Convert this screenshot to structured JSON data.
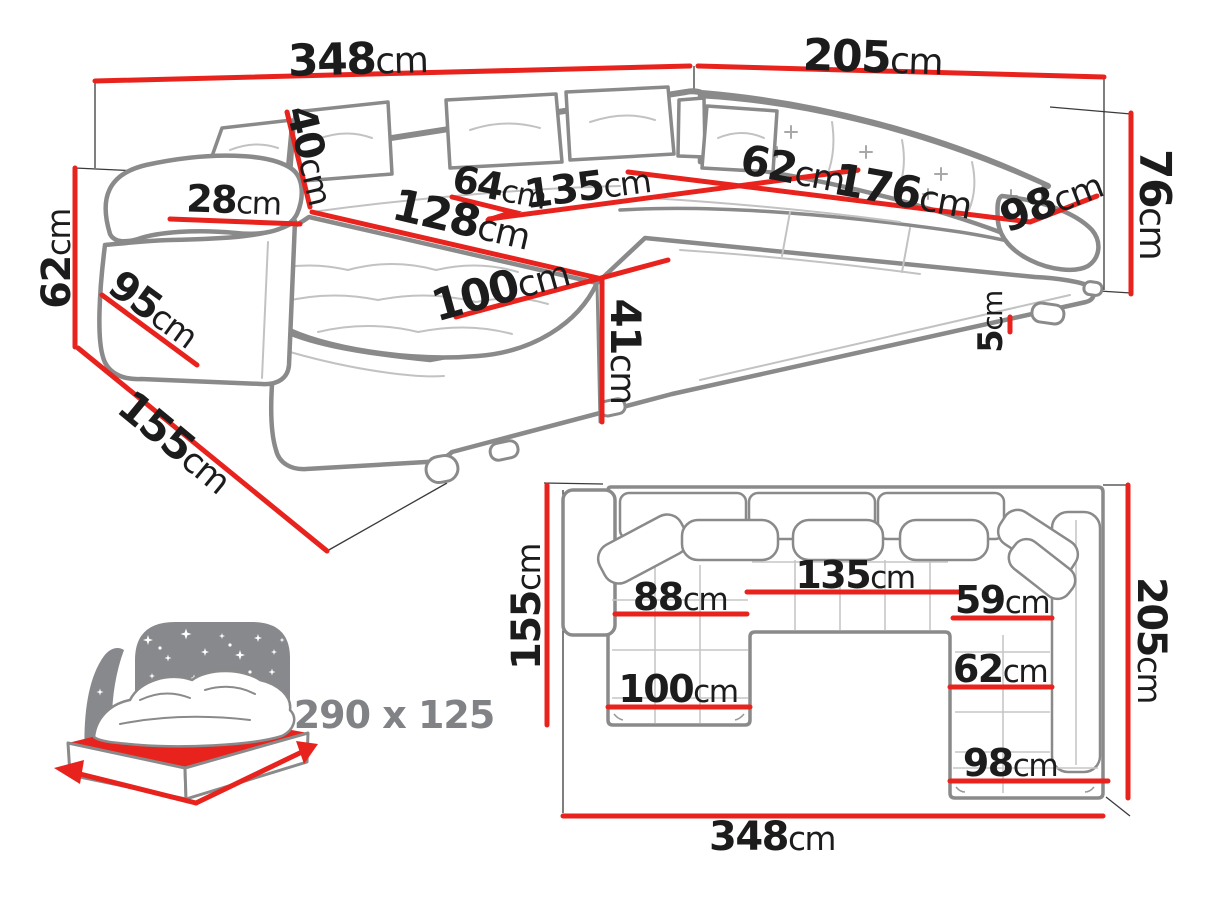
{
  "colors": {
    "dimension_red": "#e8231d",
    "text_dark": "#1c1c1c",
    "sofa_outline_gray": "#8a8a8a",
    "sofa_detail_gray": "#c2c2c2",
    "icon_gray": "#87898c",
    "icon_label_gray": "#808285",
    "background": "#ffffff"
  },
  "view3d": {
    "dims": {
      "back_width": {
        "value": "348",
        "unit": "cm"
      },
      "right_width": {
        "value": "205",
        "unit": "cm"
      },
      "back_height": {
        "value": "76",
        "unit": "cm"
      },
      "arm_height": {
        "value": "62",
        "unit": "cm"
      },
      "chaise_floor_depth": {
        "value": "155",
        "unit": "cm"
      },
      "arm_depth": {
        "value": "95",
        "unit": "cm"
      },
      "arm_width": {
        "value": "28",
        "unit": "cm"
      },
      "cushion_height": {
        "value": "40",
        "unit": "cm"
      },
      "seat_64": {
        "value": "64",
        "unit": "cm"
      },
      "seat_135": {
        "value": "135",
        "unit": "cm"
      },
      "seat_128": {
        "value": "128",
        "unit": "cm"
      },
      "corner_seat_62": {
        "value": "62",
        "unit": "cm"
      },
      "seat_176": {
        "value": "176",
        "unit": "cm"
      },
      "right_depth_98": {
        "value": "98",
        "unit": "cm"
      },
      "chaise_width_100": {
        "value": "100",
        "unit": "cm"
      },
      "seat_height_41": {
        "value": "41",
        "unit": "cm"
      },
      "leg_height_5": {
        "value": "5",
        "unit": "cm"
      }
    }
  },
  "sleep_icon": {
    "bed_size_label": "290 x 125"
  },
  "plan": {
    "dims": {
      "chaise_depth_155": {
        "value": "155",
        "unit": "cm"
      },
      "chaise_seat_88": {
        "value": "88",
        "unit": "cm"
      },
      "middle_seat_135": {
        "value": "135",
        "unit": "cm"
      },
      "right_seat_59": {
        "value": "59",
        "unit": "cm"
      },
      "chaise_width_100": {
        "value": "100",
        "unit": "cm"
      },
      "right_seat_62": {
        "value": "62",
        "unit": "cm"
      },
      "right_width_98": {
        "value": "98",
        "unit": "cm"
      },
      "right_depth_205": {
        "value": "205",
        "unit": "cm"
      },
      "total_width_348": {
        "value": "348",
        "unit": "cm"
      }
    }
  }
}
